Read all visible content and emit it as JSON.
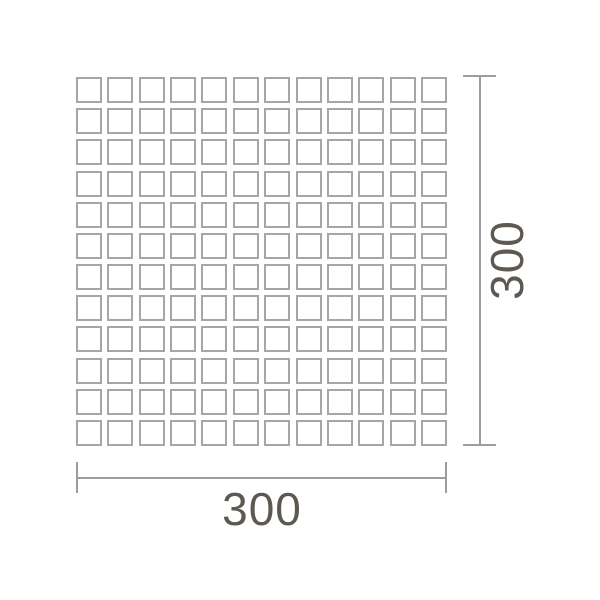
{
  "diagram": {
    "type": "tile-sheet-dimension-drawing",
    "grid": {
      "rows": 12,
      "columns": 12
    },
    "dimensions": {
      "width_label": "300",
      "height_label": "300"
    },
    "colors": {
      "background": "#ffffff",
      "dimension_line": "#9d9d9d",
      "tile_border": "#a6a6a6",
      "label_text": "#5d5952"
    }
  }
}
